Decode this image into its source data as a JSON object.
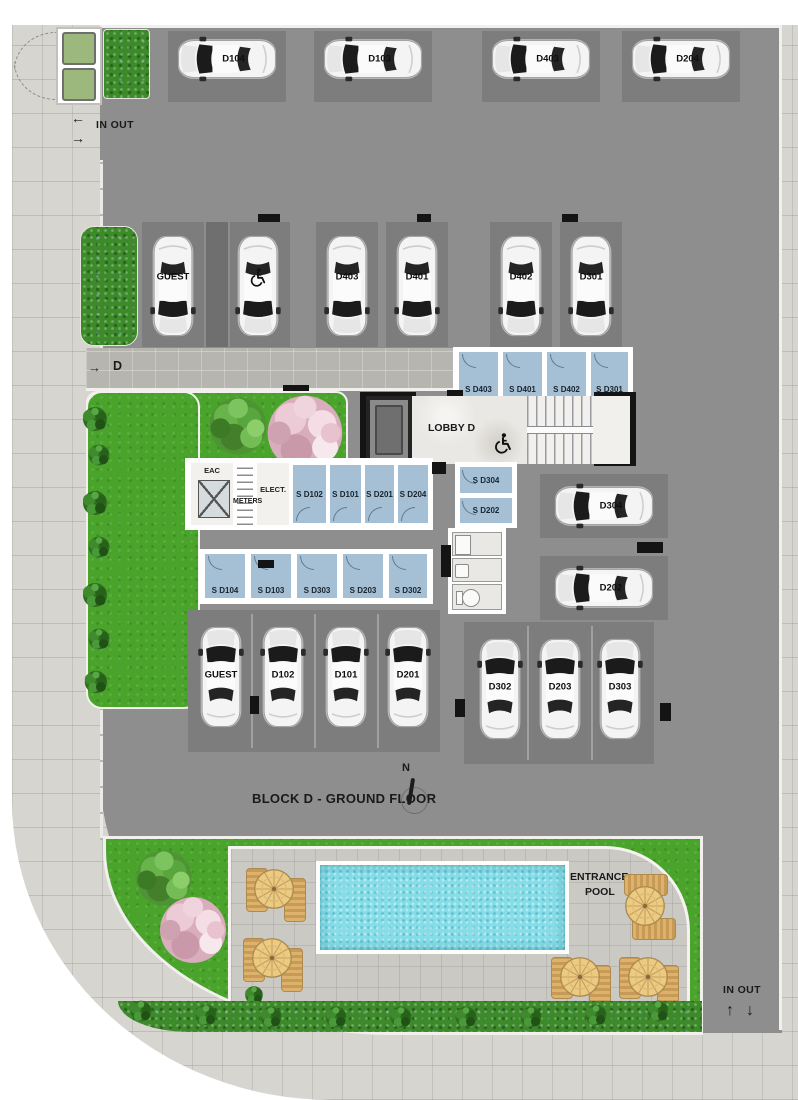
{
  "plan": {
    "title": "BLOCK D - GROUND FLOOR",
    "compass": "N"
  },
  "colors": {
    "asphalt": "#8e8e8e",
    "stall_pad": "#7d7d7d",
    "sidewalk": "#d7d5d0",
    "storage_room": "#a5c0d4",
    "grass": "#4aa42c",
    "hedge": "#3d8a2b",
    "pool_water": "#86dde8",
    "deck": "#cbc9c4",
    "wall": "#ffffff",
    "ink": "#141414"
  },
  "icons": {
    "accessible_stall": "wheelchair-icon",
    "lobby_accessible": "wheelchair-icon",
    "compass": "north-needle-icon",
    "gate": "swing-gate-arcs"
  },
  "entrance_top": {
    "label": "IN OUT",
    "in_arrow": "←",
    "out_arrow": "→"
  },
  "entrance_bottom": {
    "label": "IN OUT",
    "in_arrow": "↑",
    "out_arrow": "↓"
  },
  "ramp": {
    "arrow": "→",
    "label": "D"
  },
  "parking": {
    "top_row": [
      "D104",
      "D103",
      "D403",
      "D204"
    ],
    "middle_row": [
      "GUEST",
      "D403",
      "D401",
      "D402",
      "D301"
    ],
    "right_column": [
      "D304",
      "D202"
    ],
    "bottom_left": [
      "GUEST",
      "D102",
      "D101",
      "D201"
    ],
    "bottom_right": [
      "D302",
      "D203",
      "D303"
    ]
  },
  "storage": {
    "upper": [
      "S D403",
      "S D401",
      "S D402",
      "S D301"
    ],
    "middle": [
      "S D102",
      "S D101",
      "S D201",
      "S D204"
    ],
    "stack": [
      "S D304",
      "S D202"
    ],
    "lower": [
      "S D104",
      "S D103",
      "S D303",
      "S D203",
      "S D302"
    ]
  },
  "rooms": {
    "eac": "EAC",
    "meters": "METERS",
    "elect": "ELECT.",
    "lobby": "LOBBY D"
  },
  "pool": {
    "label_line1": "ENTRANCE",
    "label_line2": "POOL"
  }
}
